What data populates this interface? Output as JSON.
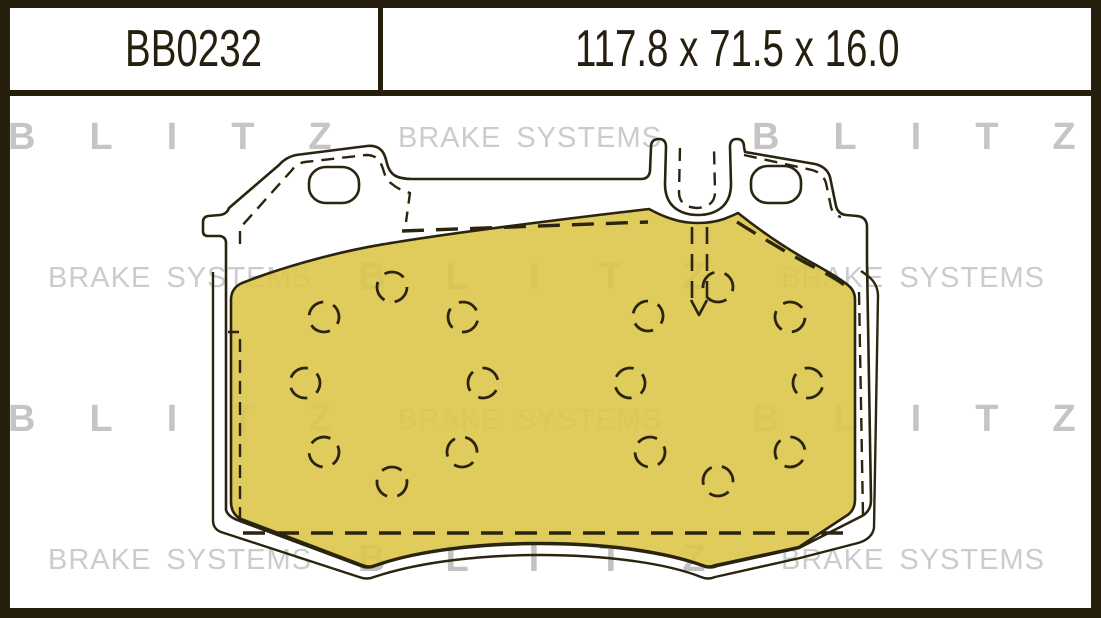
{
  "header": {
    "part_number": "BB0232",
    "dimensions": "117.8 x 71.5 x 16.0"
  },
  "watermark": {
    "brand": "BLITZ",
    "tagline": "BRAKE SYSTEMS",
    "rows": [
      {
        "items": [
          {
            "text": "BLITZ",
            "style": "blitz",
            "x": 8,
            "y": 118
          },
          {
            "text": "BRAKE SYSTEMS",
            "style": "bsys",
            "x": 398,
            "y": 124
          },
          {
            "text": "BLITZ",
            "style": "blitz",
            "x": 752,
            "y": 118
          }
        ]
      },
      {
        "items": [
          {
            "text": "BRAKE SYSTEMS",
            "style": "bsys",
            "x": 48,
            "y": 264
          },
          {
            "text": "BLITZ",
            "style": "blitz-c",
            "x": 358,
            "y": 258
          },
          {
            "text": "BRAKE SYSTEMS",
            "style": "bsys",
            "x": 781,
            "y": 264
          }
        ]
      },
      {
        "items": [
          {
            "text": "BLITZ",
            "style": "blitz",
            "x": 8,
            "y": 400
          },
          {
            "text": "BRAKE SYSTEMS",
            "style": "bsys",
            "x": 398,
            "y": 406
          },
          {
            "text": "BLITZ",
            "style": "blitz",
            "x": 752,
            "y": 400
          }
        ]
      },
      {
        "items": [
          {
            "text": "BRAKE SYSTEMS",
            "style": "bsys",
            "x": 48,
            "y": 546
          },
          {
            "text": "BLITZ",
            "style": "blitz-c",
            "x": 358,
            "y": 540
          },
          {
            "text": "BRAKE SYSTEMS",
            "style": "bsys",
            "x": 781,
            "y": 546
          }
        ]
      }
    ]
  },
  "colors": {
    "frame_dark": "#261f0d",
    "line_dark": "#2b240f",
    "friction_yellow": "#ddc64b",
    "watermark_gray": "#c5c5c5",
    "background": "#ffffff"
  },
  "drawing": {
    "description": "brake pad front view, friction surface with chamfer hole pattern",
    "friction_holes": [
      [
        392,
        287
      ],
      [
        324,
        317
      ],
      [
        463,
        317
      ],
      [
        305,
        383
      ],
      [
        483,
        383
      ],
      [
        324,
        452
      ],
      [
        462,
        452
      ],
      [
        392,
        482
      ],
      [
        718,
        287
      ],
      [
        790,
        317
      ],
      [
        648,
        316
      ],
      [
        808,
        383
      ],
      [
        630,
        383
      ],
      [
        790,
        452
      ],
      [
        650,
        452
      ],
      [
        718,
        481
      ]
    ],
    "hole_radius": 15
  }
}
